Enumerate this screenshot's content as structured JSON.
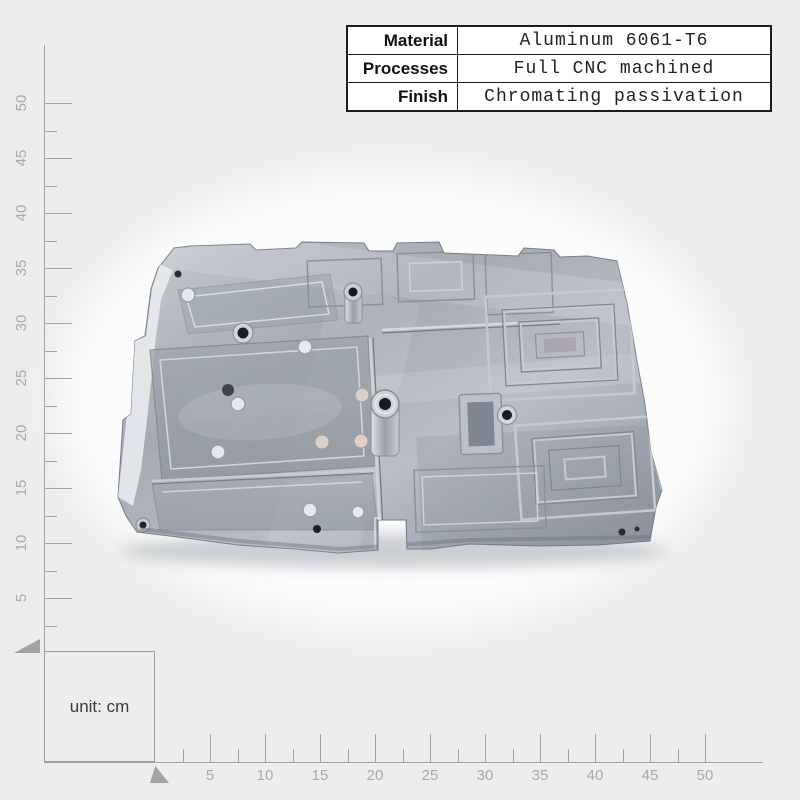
{
  "page": {
    "bg_color": "#edeeec",
    "photo_bg_color": "#fcfcfd"
  },
  "spec_table": {
    "rows": [
      {
        "label": "Material",
        "value": "Aluminum 6061-T6"
      },
      {
        "label": "Processes",
        "value": "Full CNC machined"
      },
      {
        "label": "Finish",
        "value": "Chromating passivation"
      }
    ]
  },
  "scale": {
    "unit_note": "unit: cm",
    "ruler_color": "#a3a3a3",
    "ruler_text_color": "#a8a8a8",
    "vertical_ruler": {
      "tick_labels": [
        "5",
        "10",
        "15",
        "20",
        "25",
        "30",
        "35",
        "40",
        "45",
        "50"
      ]
    },
    "horizontal_ruler": {
      "tick_labels": [
        "5",
        "10",
        "15",
        "20",
        "25",
        "30",
        "35",
        "40",
        "45",
        "50"
      ]
    }
  },
  "product": {
    "subject": "CNC machined aluminum plate with milled pockets and holes",
    "metal_color": "#a9aeb6",
    "metal_highlight": "#d7dade",
    "metal_shadow": "#7b818b"
  }
}
